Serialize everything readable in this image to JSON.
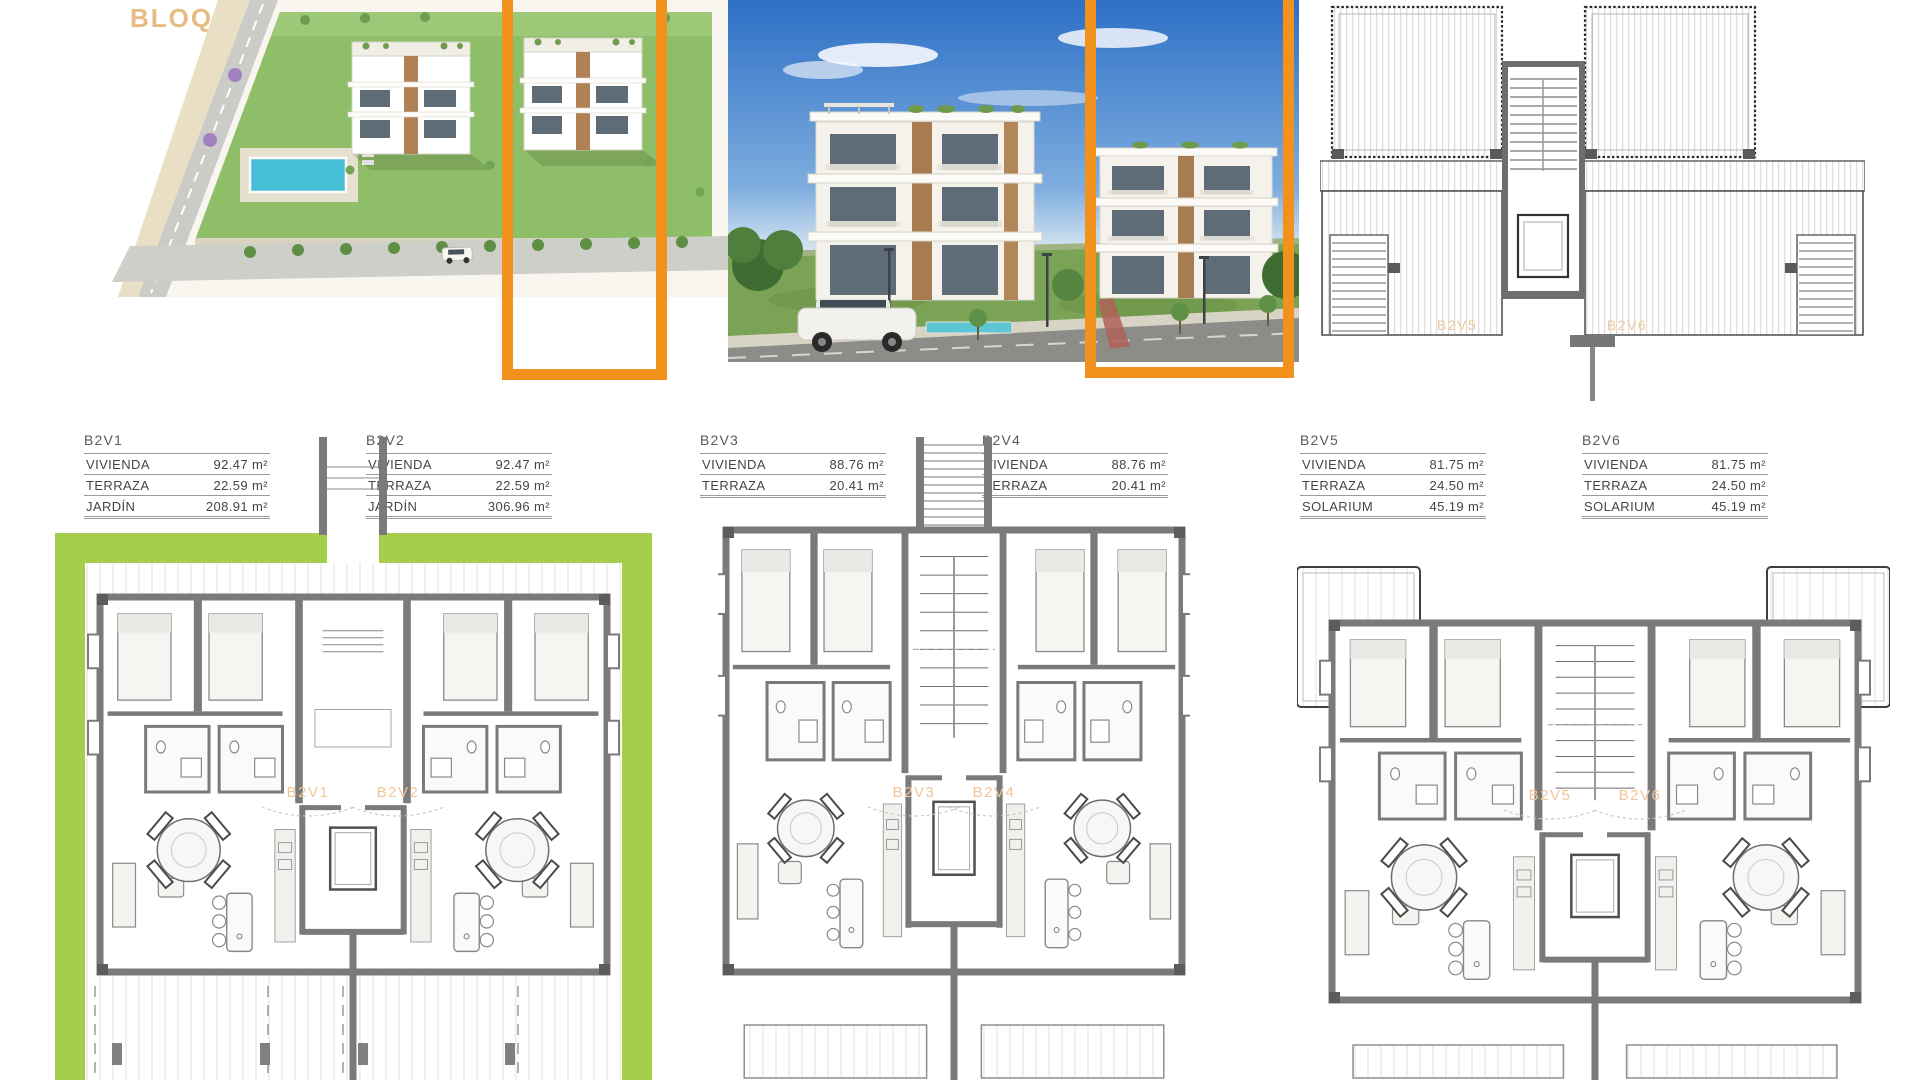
{
  "page": {
    "title": "BLOQUE 2"
  },
  "colors": {
    "accent_orange": "#F2921D",
    "title_tan": "#E7BC82",
    "plan_label": "#F0C698",
    "garden_green": "#A6CE4D",
    "wall_gray": "#7A7A7A"
  },
  "units": [
    {
      "id": "B2V1",
      "rows": [
        {
          "label": "VIVIENDA",
          "value": "92.47 m²"
        },
        {
          "label": "TERRAZA",
          "value": "22.59 m²"
        },
        {
          "label": "JARDÍN",
          "value": "208.91 m²"
        }
      ]
    },
    {
      "id": "B2V2",
      "rows": [
        {
          "label": "VIVIENDA",
          "value": "92.47 m²"
        },
        {
          "label": "TERRAZA",
          "value": "22.59 m²"
        },
        {
          "label": "JARDÍN",
          "value": "306.96 m²"
        }
      ]
    },
    {
      "id": "B2V3",
      "rows": [
        {
          "label": "VIVIENDA",
          "value": "88.76 m²"
        },
        {
          "label": "TERRAZA",
          "value": "20.41 m²"
        }
      ]
    },
    {
      "id": "B2V4",
      "rows": [
        {
          "label": "VIVIENDA",
          "value": "88.76 m²"
        },
        {
          "label": "TERRAZA",
          "value": "20.41 m²"
        }
      ]
    },
    {
      "id": "B2V5",
      "rows": [
        {
          "label": "VIVIENDA",
          "value": "81.75 m²"
        },
        {
          "label": "TERRAZA",
          "value": "24.50 m²"
        },
        {
          "label": "SOLARIUM",
          "value": "45.19 m²"
        }
      ]
    },
    {
      "id": "B2V6",
      "rows": [
        {
          "label": "VIVIENDA",
          "value": "81.75 m²"
        },
        {
          "label": "TERRAZA",
          "value": "24.50 m²"
        },
        {
          "label": "SOLARIUM",
          "value": "45.19 m²"
        }
      ]
    }
  ],
  "plans": {
    "ground": {
      "left_label": "B2V1",
      "right_label": "B2V2"
    },
    "first": {
      "left_label": "B2V3",
      "right_label": "B2V4"
    },
    "top": {
      "left_label": "B2V5",
      "right_label": "B2V6"
    },
    "roof": {
      "left_label": "B2V5",
      "right_label": "B2V6"
    }
  }
}
